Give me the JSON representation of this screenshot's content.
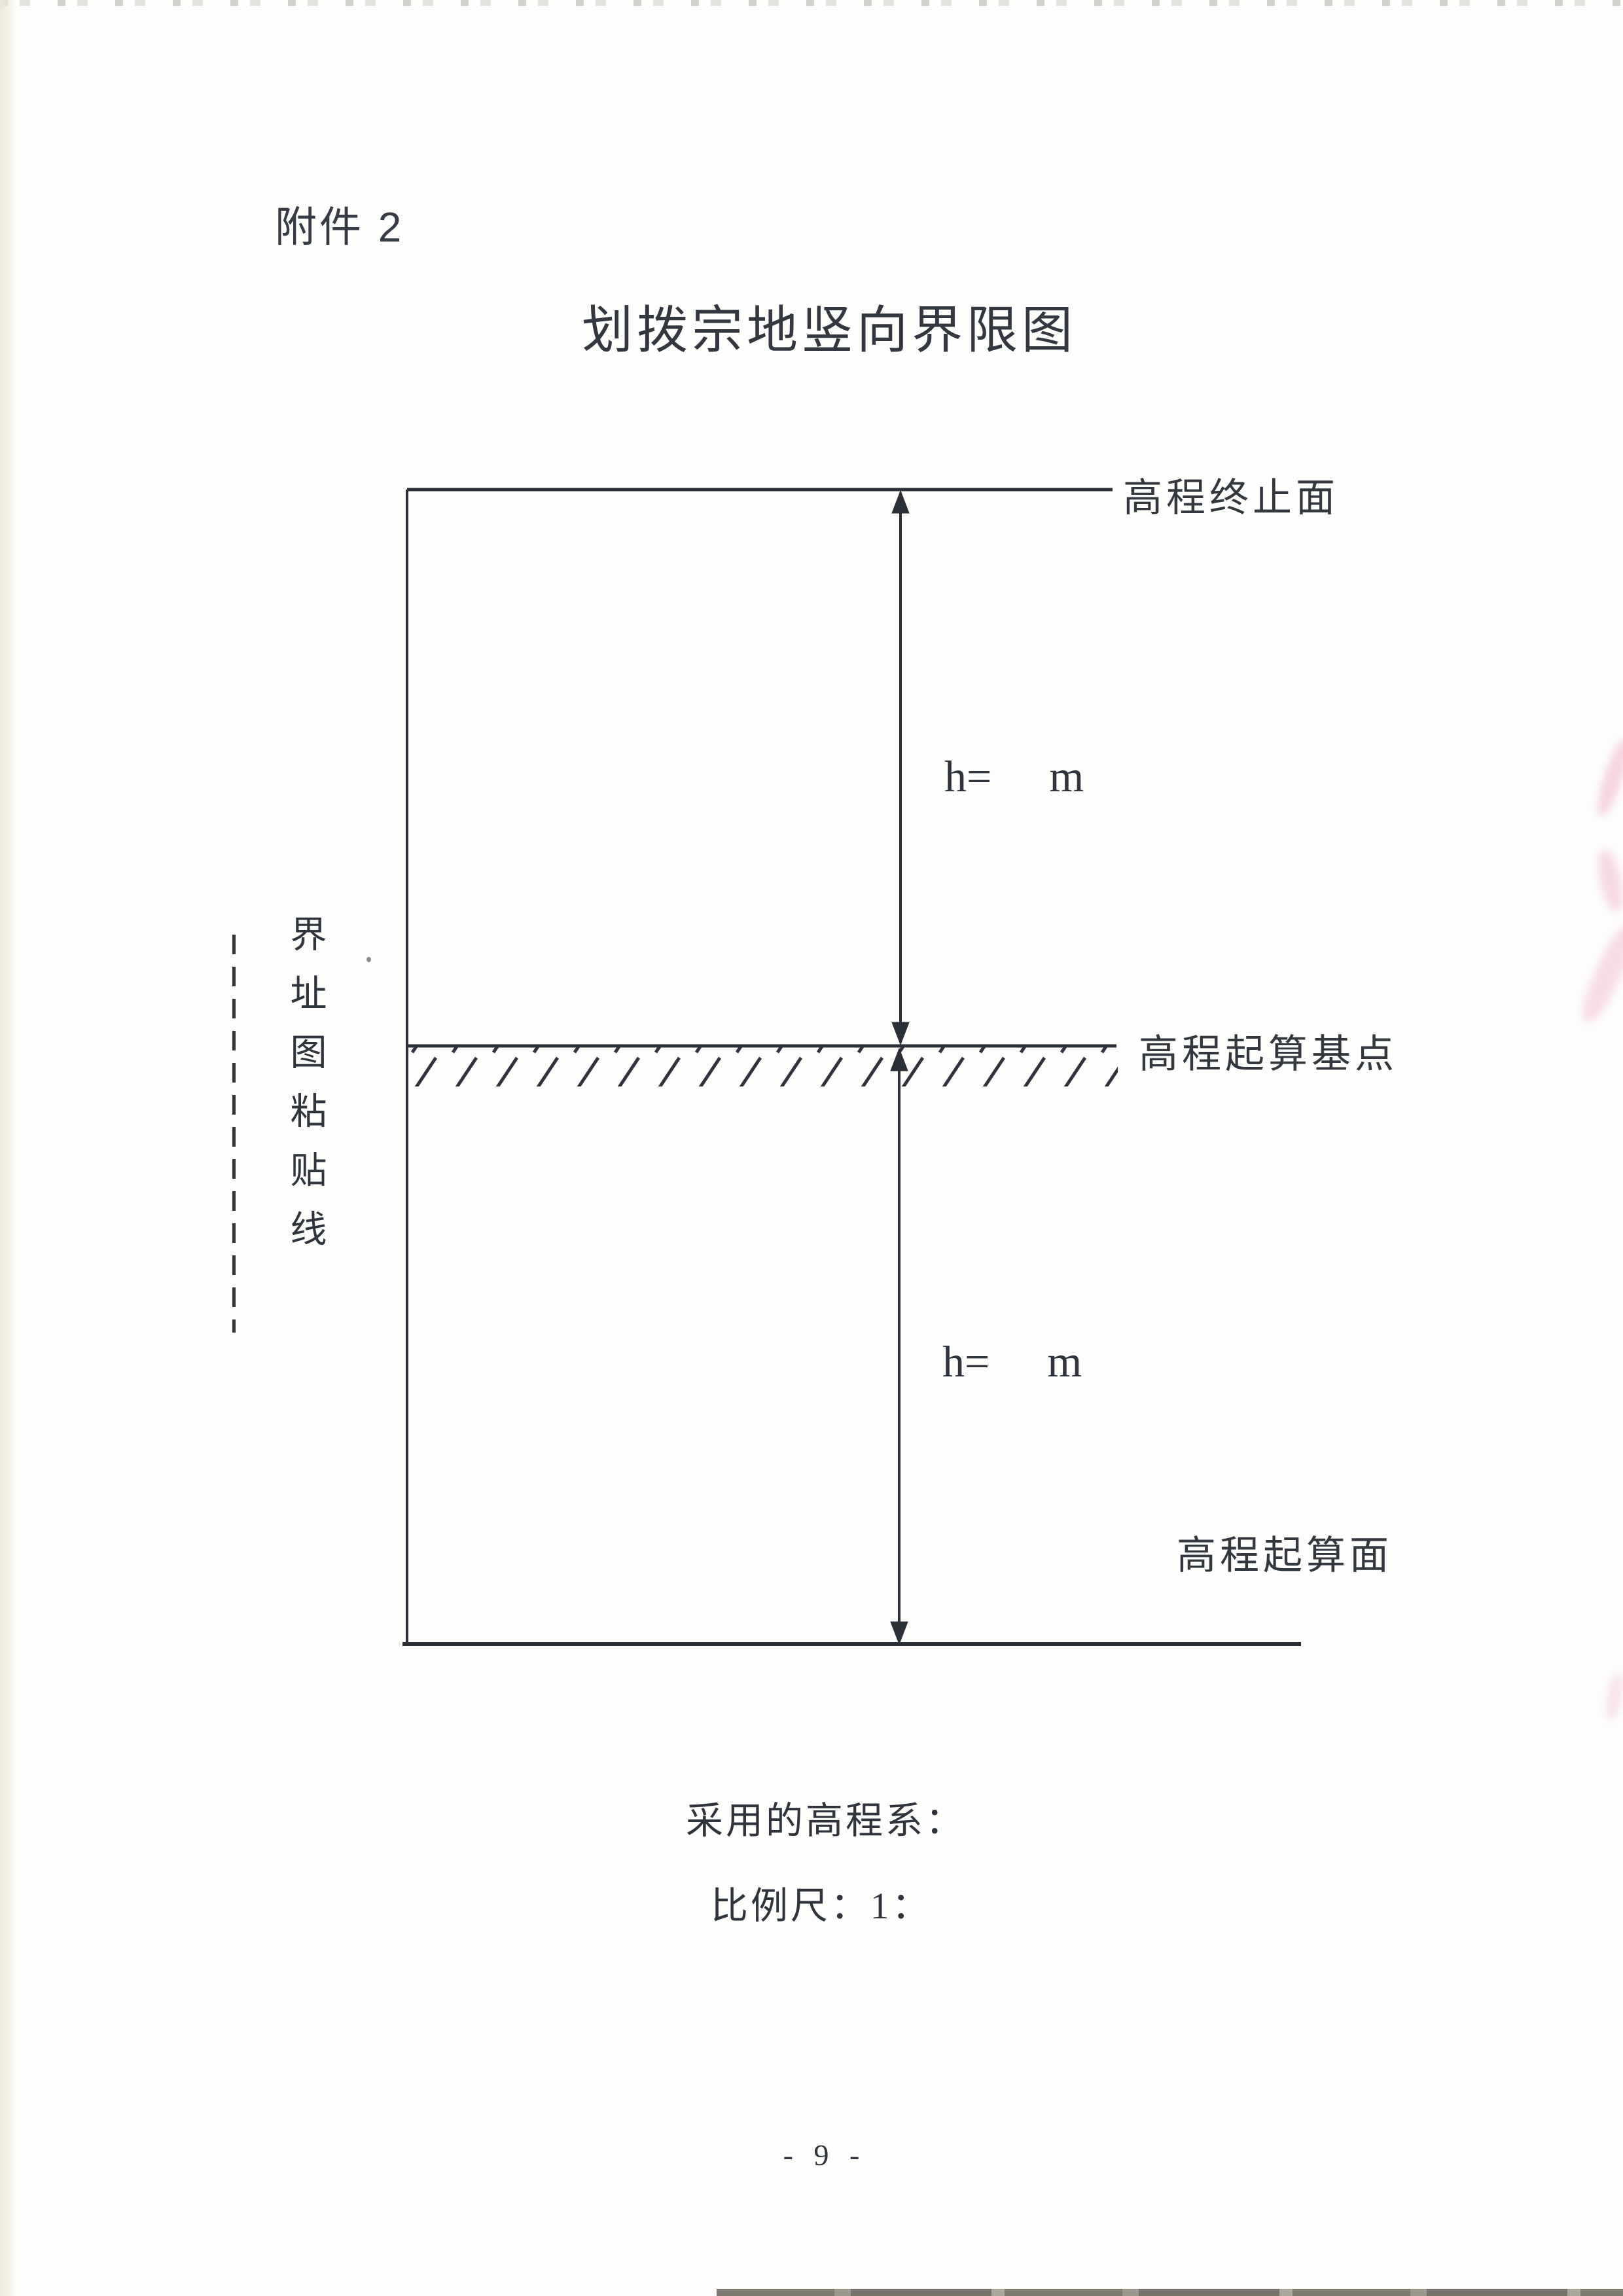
{
  "page": {
    "attachment_label": "附件 2",
    "title": "划拨宗地竖向界限图",
    "page_number": "- 9 -"
  },
  "diagram": {
    "label_top_surface": "高程终止面",
    "label_datum_point": "高程起算基点",
    "label_base_surface": "高程起算面",
    "upper_dimension": {
      "prefix": "h=",
      "unit": "m"
    },
    "lower_dimension": {
      "prefix": "h=",
      "unit": "m"
    },
    "paste_line_caption": "界址图粘贴线"
  },
  "footer": {
    "elevation_system_label": "采用的高程系：",
    "scale_label": "比例尺：1："
  },
  "colors": {
    "ink": "#2f333b",
    "text": "#33383f",
    "stamp_bleed": "#e896b4"
  }
}
